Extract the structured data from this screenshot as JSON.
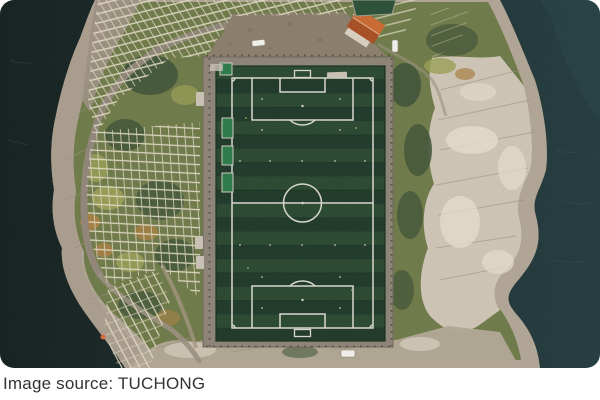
{
  "photo": {
    "alt": "Aerial drone view of a green football pitch on a rocky sea-bound peninsula, flanked by wooden fish-drying racks, a small orange-roofed building and dark teal water",
    "caption": "Image source: TUCHONG"
  },
  "colors": {
    "page-bg": "#ffffff",
    "water-left": "#16211f",
    "water-right": "#243c3f",
    "rock": "#b0a595",
    "rock-light": "#cdc4b4",
    "rock-bright": "#e5ddcd",
    "shore": "#a99d8d",
    "veg": "#6f7a49",
    "veg-dark": "#45583a",
    "veg-yellow": "#9aa057",
    "veg-orange": "#a87f42",
    "track": "#8d8476",
    "gravel": "#8a7e6c",
    "road": "#8f8678",
    "turf": "#20392a",
    "turf-light": "#2a4831",
    "field-line": "#d9d8cf",
    "rack": "#e6dfcb",
    "dugout-green": "#2d7a4a",
    "roof-light": "#c96a33",
    "roof-dark": "#a84e24",
    "fence": "#4e4941",
    "vehicle": "#f0efe9",
    "caption-text": "#333333"
  }
}
